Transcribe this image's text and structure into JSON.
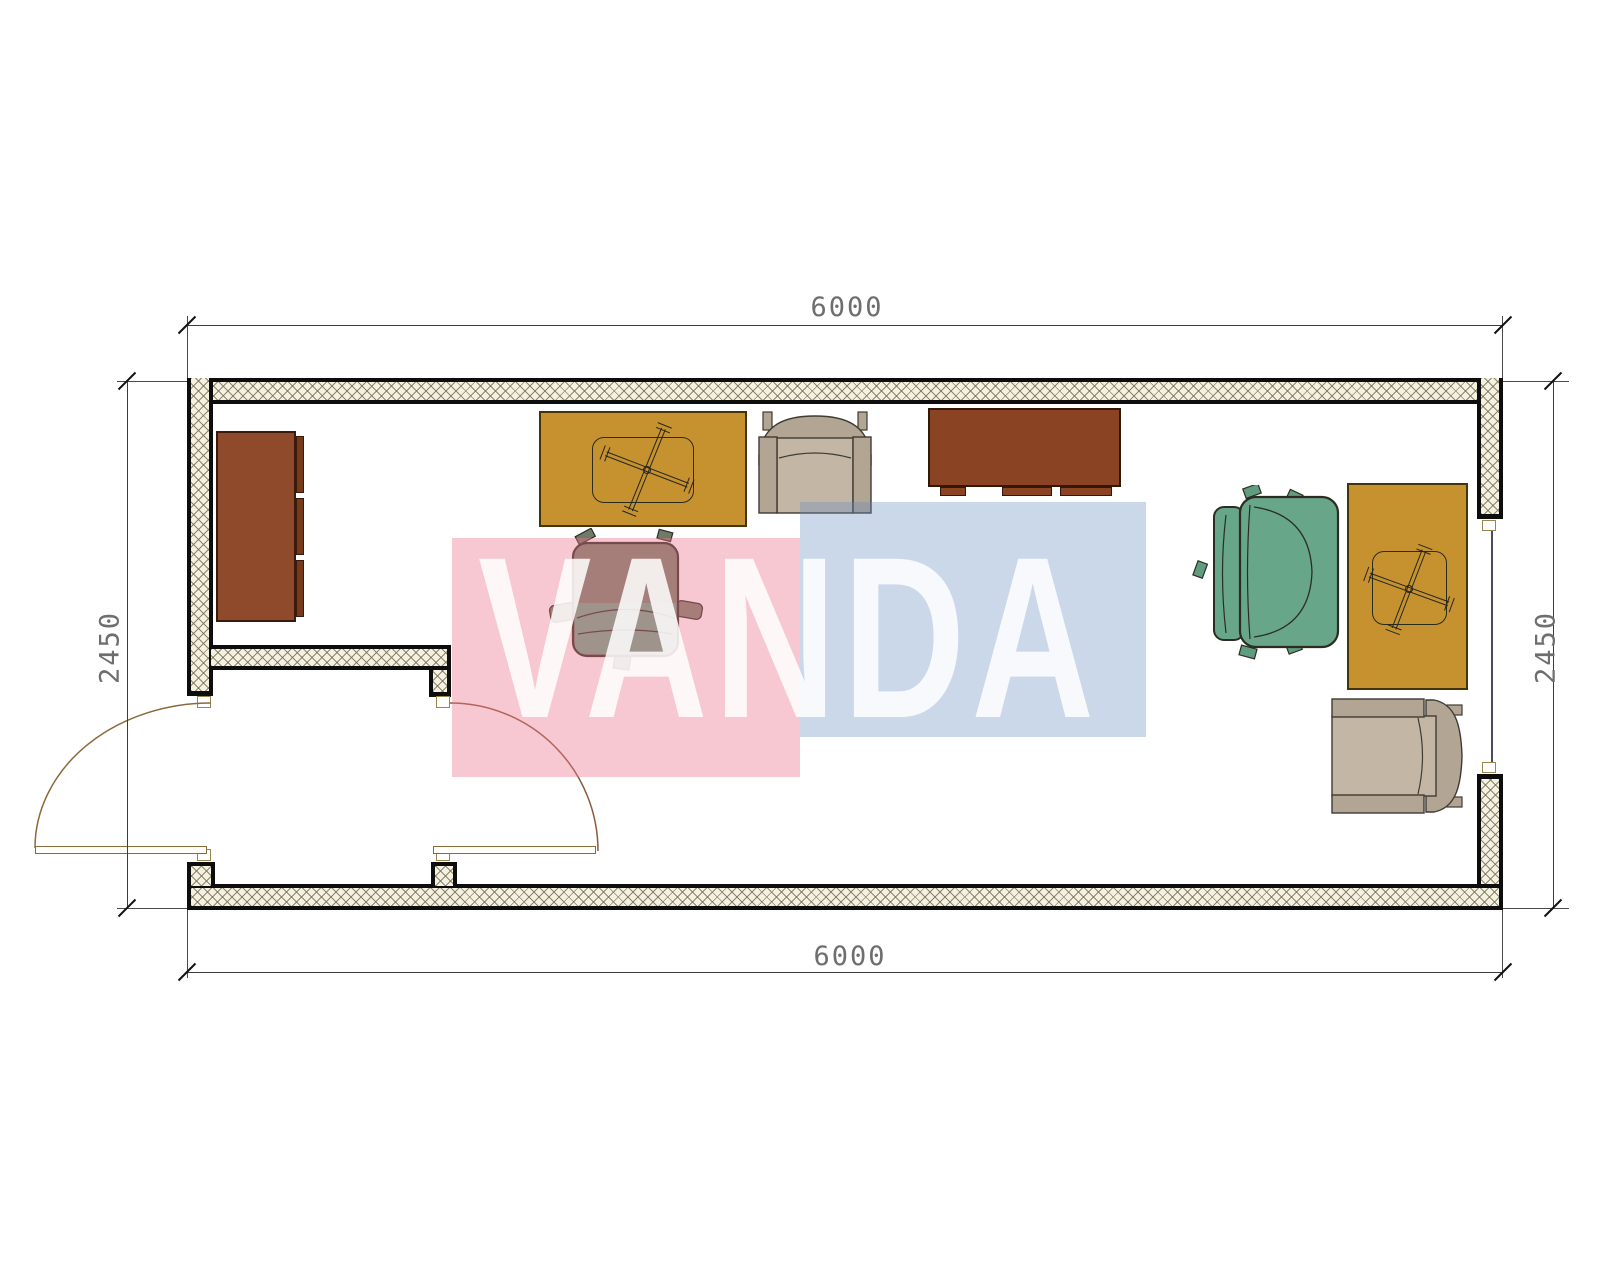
{
  "title": "container-office-floor-plan",
  "dimensions": {
    "top_width": "6000",
    "bottom_width": "6000",
    "left_height": "2450",
    "right_height": "2450"
  },
  "watermark": {
    "text": "VANDA",
    "pink_block_color": "#f6c9d2",
    "blue_block_color": "#cdd9e9"
  },
  "colors": {
    "wall_fill": "#f4f0e2",
    "wall_edge": "#0d0d0d",
    "hatch_line": "#7a7254",
    "desk": "#c6922f",
    "cabinet": "#8e4a2a",
    "sideboard": "#8b4423",
    "chair_teal": "#67a689",
    "chair_seat_sage": "#76826b",
    "armchair_frame": "#b3a593",
    "armchair_seat": "#c3b6a5",
    "door_line": "#8a6a3a"
  },
  "furniture": [
    {
      "kind": "cabinet",
      "position": "left-wall"
    },
    {
      "kind": "desk-with-x-base",
      "position": "top-center"
    },
    {
      "kind": "office-chair",
      "position": "center"
    },
    {
      "kind": "armchair",
      "position": "top-center"
    },
    {
      "kind": "sideboard",
      "position": "top-right-of-center"
    },
    {
      "kind": "office-chair",
      "position": "right"
    },
    {
      "kind": "desk-with-x-base",
      "position": "right-wall"
    },
    {
      "kind": "armchair",
      "position": "bottom-right"
    }
  ],
  "openings": [
    {
      "kind": "double-swing-doors",
      "position": "bottom-left-vestibule"
    },
    {
      "kind": "window",
      "position": "right-wall"
    }
  ]
}
